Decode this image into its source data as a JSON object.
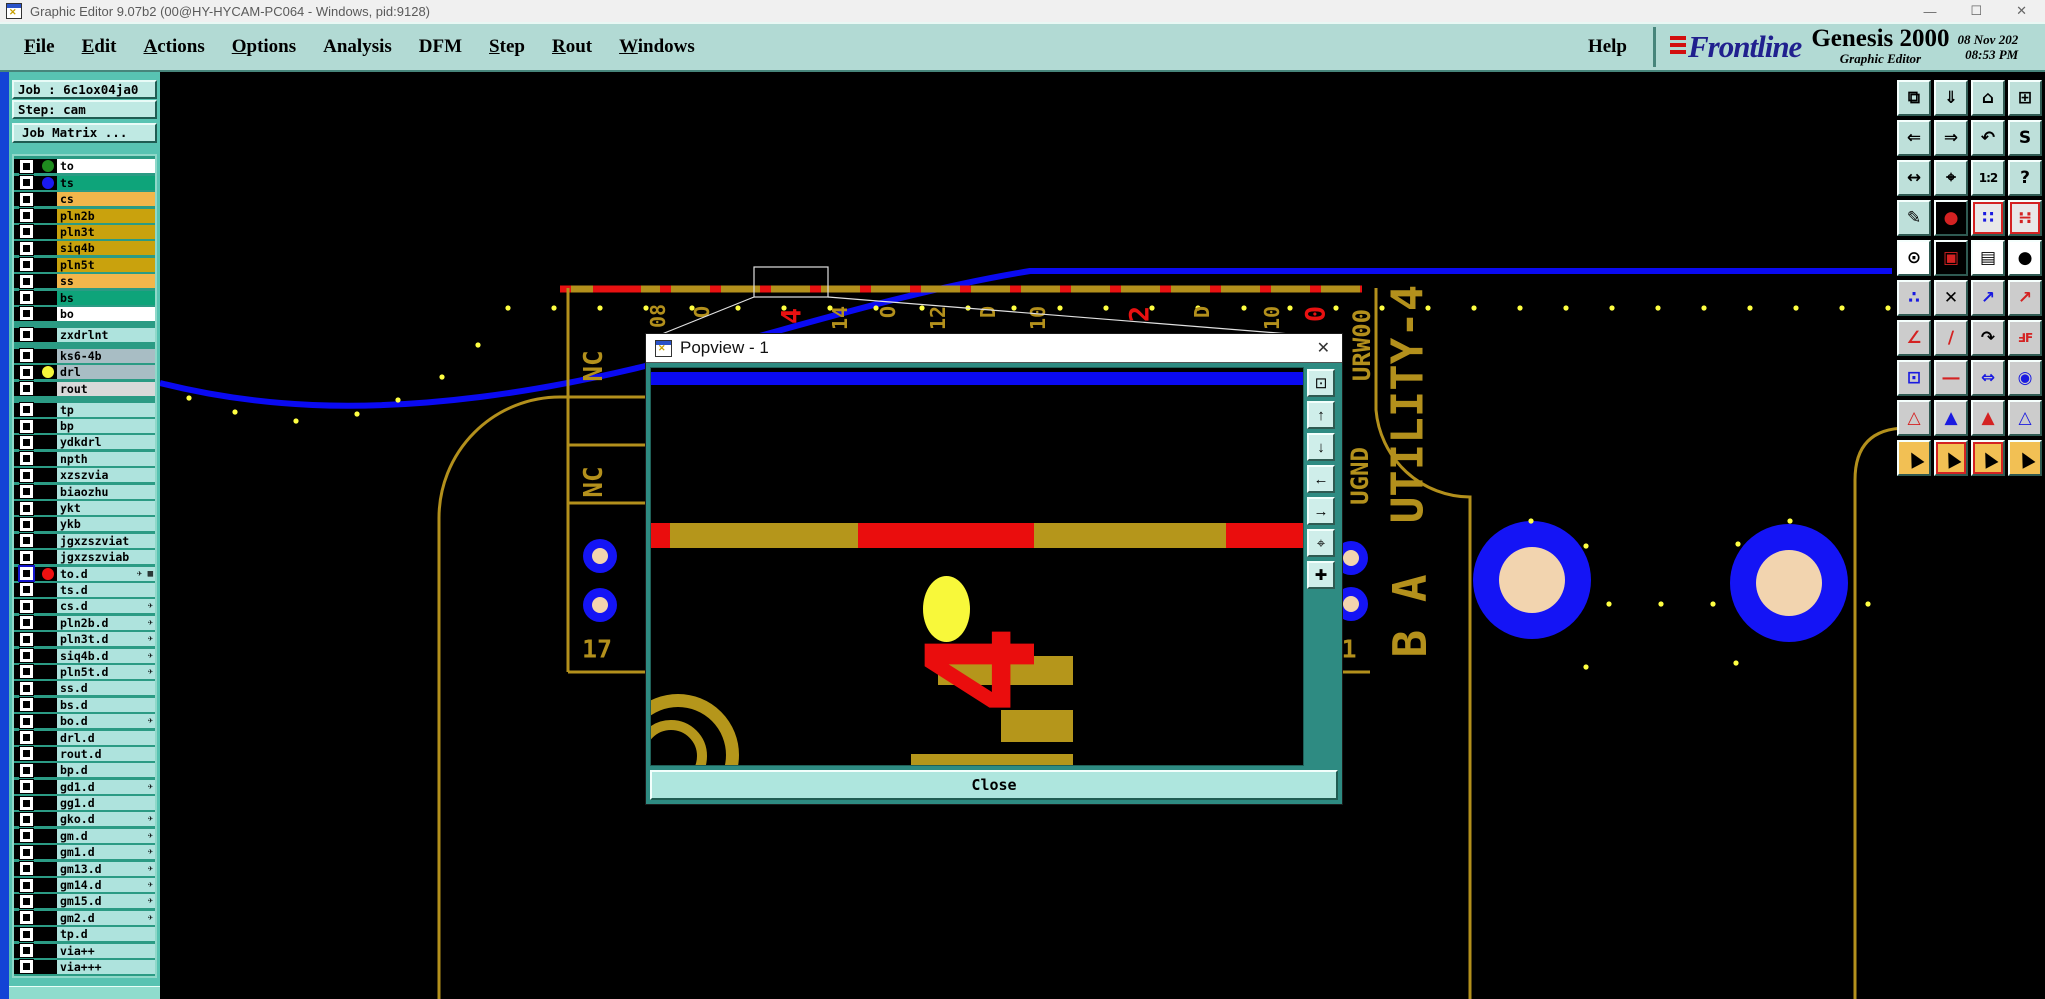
{
  "window": {
    "title": "Graphic Editor 9.07b2 (00@HY-HYCAM-PC064 - Windows, pid:9128)",
    "controls": {
      "minimize": "—",
      "maximize": "☐",
      "close": "✕"
    }
  },
  "menu": {
    "items": [
      {
        "label": "File",
        "u": true
      },
      {
        "label": "Edit",
        "u": true
      },
      {
        "label": "Actions",
        "u": true
      },
      {
        "label": "Options",
        "u": true
      },
      {
        "label": "Analysis",
        "u": false
      },
      {
        "label": "DFM",
        "u": false
      },
      {
        "label": "Step",
        "u": true
      },
      {
        "label": "Rout",
        "u": true
      },
      {
        "label": "Windows",
        "u": true
      }
    ],
    "help": "Help"
  },
  "brand": {
    "logo": "Frontline",
    "product": "Genesis 2000",
    "tagline": "Graphic Editor",
    "date": "08 Nov 202",
    "time": "08:53 PM"
  },
  "job": {
    "job_label": "Job : 6c1ox04ja0",
    "step_label": "Step: cam",
    "matrix_button": "Job Matrix ..."
  },
  "layers": [
    {
      "name": "to",
      "bg": "#ffffff",
      "dot": "#1f8c1f"
    },
    {
      "name": "ts",
      "bg": "#0ea47a",
      "dot": "#1a1af0"
    },
    {
      "name": "cs",
      "bg": "#f2b64b"
    },
    {
      "name": "pln2b",
      "bg": "#c9a20d"
    },
    {
      "name": "pln3t",
      "bg": "#c9a20d"
    },
    {
      "name": "siq4b",
      "bg": "#c9a20d"
    },
    {
      "name": "pln5t",
      "bg": "#c9a20d"
    },
    {
      "name": "ss",
      "bg": "#f2b64b"
    },
    {
      "name": "bs",
      "bg": "#0ea47a"
    },
    {
      "name": "bo",
      "bg": "#ffffff"
    },
    {
      "name": "zxdrlnt",
      "bg": "#aee3dd",
      "gap": true
    },
    {
      "name": "ks6-4b",
      "bg": "#a8bdc4",
      "gap": true
    },
    {
      "name": "drl",
      "bg": "#a8bdc4",
      "dot": "#f5f53a"
    },
    {
      "name": "rout",
      "bg": "#d9d9d9"
    },
    {
      "name": "tp",
      "bg": "#aee3dd",
      "gap": true
    },
    {
      "name": "bp",
      "bg": "#aee3dd"
    },
    {
      "name": "ydkdrl",
      "bg": "#aee3dd"
    },
    {
      "name": "npth",
      "bg": "#aee3dd"
    },
    {
      "name": "xzszvia",
      "bg": "#aee3dd"
    },
    {
      "name": "biaozhu",
      "bg": "#aee3dd"
    },
    {
      "name": "ykt",
      "bg": "#aee3dd"
    },
    {
      "name": "ykb",
      "bg": "#aee3dd"
    },
    {
      "name": "jgxzszviat",
      "bg": "#aee3dd"
    },
    {
      "name": "jgxzszviab",
      "bg": "#aee3dd"
    },
    {
      "name": "to.d",
      "bg": "#aee3dd",
      "dot": "#ee1111",
      "sel": true,
      "icons": "✈ ▦"
    },
    {
      "name": "ts.d",
      "bg": "#aee3dd"
    },
    {
      "name": "cs.d",
      "bg": "#aee3dd",
      "icons": "✈"
    },
    {
      "name": "pln2b.d",
      "bg": "#aee3dd",
      "icons": "✈"
    },
    {
      "name": "pln3t.d",
      "bg": "#aee3dd",
      "icons": "✈"
    },
    {
      "name": "siq4b.d",
      "bg": "#aee3dd",
      "icons": "✈"
    },
    {
      "name": "pln5t.d",
      "bg": "#aee3dd",
      "icons": "✈"
    },
    {
      "name": "ss.d",
      "bg": "#aee3dd"
    },
    {
      "name": "bs.d",
      "bg": "#aee3dd"
    },
    {
      "name": "bo.d",
      "bg": "#aee3dd",
      "icons": "✈"
    },
    {
      "name": "drl.d",
      "bg": "#aee3dd"
    },
    {
      "name": "rout.d",
      "bg": "#aee3dd"
    },
    {
      "name": "bp.d",
      "bg": "#aee3dd"
    },
    {
      "name": "gd1.d",
      "bg": "#aee3dd",
      "icons": "✈"
    },
    {
      "name": "gg1.d",
      "bg": "#aee3dd"
    },
    {
      "name": "gko.d",
      "bg": "#aee3dd",
      "icons": "✈"
    },
    {
      "name": "gm.d",
      "bg": "#aee3dd",
      "icons": "✈"
    },
    {
      "name": "gm1.d",
      "bg": "#aee3dd",
      "icons": "✈"
    },
    {
      "name": "gm13.d",
      "bg": "#aee3dd",
      "icons": "✈"
    },
    {
      "name": "gm14.d",
      "bg": "#aee3dd",
      "icons": "✈"
    },
    {
      "name": "gm15.d",
      "bg": "#aee3dd",
      "icons": "✈"
    },
    {
      "name": "gm2.d",
      "bg": "#aee3dd",
      "icons": "✈"
    },
    {
      "name": "tp.d",
      "bg": "#aee3dd"
    },
    {
      "name": "via++",
      "bg": "#aee3dd"
    },
    {
      "name": "via+++",
      "bg": "#aee3dd"
    }
  ],
  "canvas": {
    "labels": [
      {
        "t": "08",
        "x": 658,
        "y": 316,
        "s": 20,
        "c": "gold",
        "r": -90
      },
      {
        "t": "O",
        "x": 702,
        "y": 312,
        "s": 20,
        "c": "gold",
        "r": -90
      },
      {
        "t": "4",
        "x": 792,
        "y": 316,
        "s": 27,
        "c": "red",
        "r": -90
      },
      {
        "t": "14",
        "x": 840,
        "y": 318,
        "s": 20,
        "c": "gold",
        "r": -90
      },
      {
        "t": "O",
        "x": 888,
        "y": 312,
        "s": 20,
        "c": "gold",
        "r": -90
      },
      {
        "t": "12",
        "x": 938,
        "y": 318,
        "s": 20,
        "c": "gold",
        "r": -90
      },
      {
        "t": "D",
        "x": 988,
        "y": 312,
        "s": 20,
        "c": "gold",
        "r": -90
      },
      {
        "t": "10",
        "x": 1038,
        "y": 318,
        "s": 20,
        "c": "gold",
        "r": -90
      },
      {
        "t": "2",
        "x": 1140,
        "y": 314,
        "s": 27,
        "c": "red",
        "r": -90
      },
      {
        "t": "D",
        "x": 1202,
        "y": 312,
        "s": 20,
        "c": "gold",
        "r": -90
      },
      {
        "t": "10",
        "x": 1272,
        "y": 318,
        "s": 20,
        "c": "gold",
        "r": -90
      },
      {
        "t": "0",
        "x": 1316,
        "y": 314,
        "s": 27,
        "c": "red",
        "r": -90
      },
      {
        "t": "NC",
        "x": 594,
        "y": 366,
        "s": 26,
        "c": "gold",
        "r": -90
      },
      {
        "t": "NC",
        "x": 594,
        "y": 482,
        "s": 26,
        "c": "gold",
        "r": -90
      },
      {
        "t": "URW00",
        "x": 1362,
        "y": 345,
        "s": 24,
        "c": "gold",
        "r": -90
      },
      {
        "t": "UGND",
        "x": 1360,
        "y": 476,
        "s": 24,
        "c": "gold",
        "r": -90
      },
      {
        "t": "UTILITY-4",
        "x": 1408,
        "y": 404,
        "s": 44,
        "c": "gold",
        "r": -90
      },
      {
        "t": "B A",
        "x": 1410,
        "y": 616,
        "s": 46,
        "c": "gold",
        "r": -90
      },
      {
        "t": "17",
        "x": 597,
        "y": 649,
        "s": 25,
        "c": "gold",
        "r": 0
      },
      {
        "t": "1",
        "x": 1349,
        "y": 649,
        "s": 25,
        "c": "gold",
        "r": 0
      }
    ],
    "colors": {
      "gold": "#b3901c",
      "red": "#e81111",
      "blue": "#0a0af2",
      "pad_blue": "#1414f5",
      "peach": "#f2d4af",
      "dot_yellow": "#ffff42"
    },
    "dots": {
      "row": {
        "y": 308,
        "x0": 508,
        "step": 46,
        "n": 31
      },
      "extra": [
        [
          189,
          398
        ],
        [
          235,
          412
        ],
        [
          296,
          421
        ],
        [
          357,
          414
        ],
        [
          398,
          400
        ],
        [
          442,
          377
        ],
        [
          478,
          345
        ],
        [
          1531,
          521
        ],
        [
          1586,
          546
        ],
        [
          1609,
          604
        ],
        [
          1661,
          604
        ],
        [
          1713,
          604
        ],
        [
          1738,
          544
        ],
        [
          1790,
          521
        ],
        [
          1586,
          667
        ],
        [
          1736,
          663
        ],
        [
          1868,
          604
        ]
      ]
    }
  },
  "popview": {
    "title": "Popview - 1",
    "close_x": "✕",
    "close_label": "Close",
    "buttons": [
      {
        "name": "popview-window-icon",
        "glyph": "⊡"
      },
      {
        "name": "popview-up-icon",
        "glyph": "↑"
      },
      {
        "name": "popview-down-icon",
        "glyph": "↓"
      },
      {
        "name": "popview-left-icon",
        "glyph": "←"
      },
      {
        "name": "popview-right-icon",
        "glyph": "→"
      },
      {
        "name": "popview-center-icon",
        "glyph": "⌖"
      },
      {
        "name": "popview-pan-icon",
        "glyph": "✚"
      }
    ]
  },
  "toolbar": {
    "buttons": [
      {
        "name": "copy-screen-button",
        "glyph": "⧉",
        "bg": "#bee0da",
        "fg": "#000"
      },
      {
        "name": "screen-down-button",
        "glyph": "⇓",
        "bg": "#bee0da",
        "fg": "#000"
      },
      {
        "name": "zoom-home-button",
        "glyph": "⌂",
        "bg": "#bee0da",
        "fg": "#000"
      },
      {
        "name": "xy-window-button",
        "glyph": "⊞",
        "bg": "#bee0da",
        "fg": "#000"
      },
      {
        "name": "pan-left-button",
        "glyph": "⇐",
        "bg": "#bee0da",
        "fg": "#000"
      },
      {
        "name": "pan-right-button",
        "glyph": "⇒",
        "bg": "#bee0da",
        "fg": "#000"
      },
      {
        "name": "zoom-previous-button",
        "glyph": "↶",
        "bg": "#bee0da",
        "fg": "#000"
      },
      {
        "name": "serpentine-button",
        "glyph": "S",
        "bg": "#bee0da",
        "fg": "#000"
      },
      {
        "name": "zoom-fit-button",
        "glyph": "↔",
        "bg": "#bee0da",
        "fg": "#000"
      },
      {
        "name": "zoom-center-button",
        "glyph": "⌖",
        "bg": "#bee0da",
        "fg": "#000"
      },
      {
        "name": "scale-1-2-button",
        "glyph": "1:2",
        "bg": "#bee0da",
        "fg": "#000",
        "cls": "small"
      },
      {
        "name": "help-button",
        "glyph": "?",
        "bg": "#bee0da",
        "fg": "#000"
      },
      {
        "name": "tools-button",
        "glyph": "✎",
        "bg": "#bee0da",
        "fg": "#000"
      },
      {
        "name": "net-trace-button",
        "glyph": "●",
        "bg": "#000000",
        "fg": "#d42222"
      },
      {
        "name": "netlist-a-button",
        "glyph": "∷",
        "bg": "#e8e8e8",
        "fg": "#1a1ae0",
        "cls": "red-border"
      },
      {
        "name": "netlist-b-button",
        "glyph": "∺",
        "bg": "#e8e8e8",
        "fg": "#d42222",
        "cls": "red-border"
      },
      {
        "name": "select-feature-button",
        "glyph": "⊙",
        "bg": "#ffffff",
        "fg": "#000"
      },
      {
        "name": "active-layer-button",
        "glyph": "▣",
        "bg": "#000000",
        "fg": "#d42222"
      },
      {
        "name": "ruler-button",
        "glyph": "▤",
        "bg": "#ffffff",
        "fg": "#000"
      },
      {
        "name": "pad-select-button",
        "glyph": "●",
        "bg": "#ffffff",
        "fg": "#000"
      },
      {
        "name": "net-points-button",
        "glyph": "∴",
        "bg": "#cccccc",
        "fg": "#1a1ae0"
      },
      {
        "name": "unselect-button",
        "glyph": "✕",
        "bg": "#cccccc",
        "fg": "#000"
      },
      {
        "name": "move-vertex-button",
        "glyph": "↗",
        "bg": "#cccccc",
        "fg": "#1a1ae0"
      },
      {
        "name": "copy-vertex-button",
        "glyph": "↗",
        "bg": "#cccccc",
        "fg": "#d42222"
      },
      {
        "name": "angle-measure-button",
        "glyph": "∠",
        "bg": "#cccccc",
        "fg": "#d42222"
      },
      {
        "name": "slope-measure-button",
        "glyph": "∕",
        "bg": "#cccccc",
        "fg": "#d42222"
      },
      {
        "name": "rotate-button",
        "glyph": "↷",
        "bg": "#cccccc",
        "fg": "#000"
      },
      {
        "name": "mirror-button",
        "glyph": "ℲF",
        "bg": "#cccccc",
        "fg": "#d42222",
        "cls": "small"
      },
      {
        "name": "offset-pad-button",
        "glyph": "⊡",
        "bg": "#cccccc",
        "fg": "#1a1ae0"
      },
      {
        "name": "stretch-line-button",
        "glyph": "―",
        "bg": "#cccccc",
        "fg": "#d42222"
      },
      {
        "name": "gap-measure-button",
        "glyph": "⇔",
        "bg": "#cccccc",
        "fg": "#1a1ae0"
      },
      {
        "name": "surface-button",
        "glyph": "◉",
        "bg": "#cccccc",
        "fg": "#1a1ae0"
      },
      {
        "name": "triangle-select-1-button",
        "glyph": "△",
        "bg": "#cccccc",
        "fg": "#d42222"
      },
      {
        "name": "triangle-select-2-button",
        "glyph": "▲",
        "bg": "#cccccc",
        "fg": "#1a1ae0"
      },
      {
        "name": "triangle-select-3-button",
        "glyph": "▲",
        "bg": "#cccccc",
        "fg": "#d42222"
      },
      {
        "name": "triangle-select-4-button",
        "glyph": "△",
        "bg": "#cccccc",
        "fg": "#1a1ae0"
      },
      {
        "name": "cursor-select-button",
        "glyph": "▲",
        "bg": "#f2c054",
        "fg": "#000",
        "cls": "tilt"
      },
      {
        "name": "cursor-frame-button",
        "glyph": "▲",
        "bg": "#f2c054",
        "fg": "#000",
        "cls": "tilt red-border"
      },
      {
        "name": "cursor-poly-button",
        "glyph": "▲",
        "bg": "#f2c054",
        "fg": "#000",
        "cls": "tilt red-border"
      },
      {
        "name": "cursor-net-button",
        "glyph": "▲",
        "bg": "#f2c054",
        "fg": "#000",
        "cls": "tilt"
      }
    ]
  }
}
